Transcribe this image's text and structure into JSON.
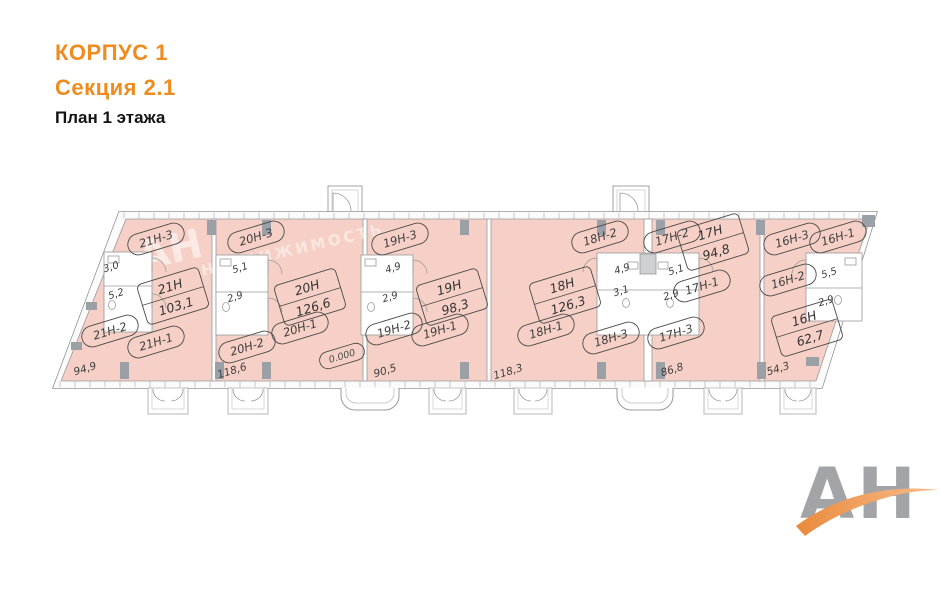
{
  "header": {
    "building": "КОРПУС 1",
    "section": "Секция 2.1",
    "floor": "План 1 этажа"
  },
  "watermark": {
    "line1": "АН",
    "line2": "НЕДВИЖИМОСТЬ"
  },
  "logo": {
    "text": "АН"
  },
  "colors": {
    "accent_orange": "#ee8c1f",
    "plan_fill": "#f6d0c6",
    "wall_gray": "#9a9a9a",
    "label_gray": "#3e3e3e",
    "logo_gray": "#a2a4a7",
    "logo_orange": "#ef9a55"
  },
  "plan": {
    "unit_ovals": [
      {
        "label": "21Н-3",
        "x": 156,
        "y": 239
      },
      {
        "label": "21Н-2",
        "x": 110,
        "y": 331
      },
      {
        "label": "21Н-1",
        "x": 156,
        "y": 342
      },
      {
        "label": "20Н-3",
        "x": 256,
        "y": 237
      },
      {
        "label": "20Н-2",
        "x": 247,
        "y": 347
      },
      {
        "label": "20Н-1",
        "x": 300,
        "y": 328
      },
      {
        "label": "19Н-3",
        "x": 400,
        "y": 239
      },
      {
        "label": "19Н-2",
        "x": 394,
        "y": 329
      },
      {
        "label": "19Н-1",
        "x": 440,
        "y": 330
      },
      {
        "label": "18Н-2",
        "x": 600,
        "y": 237
      },
      {
        "label": "18Н-1",
        "x": 546,
        "y": 330
      },
      {
        "label": "18Н-3",
        "x": 611,
        "y": 338
      },
      {
        "label": "17Н-2",
        "x": 672,
        "y": 237
      },
      {
        "label": "17Н-1",
        "x": 702,
        "y": 286
      },
      {
        "label": "17Н-3",
        "x": 676,
        "y": 333
      },
      {
        "label": "16Н-3",
        "x": 792,
        "y": 239
      },
      {
        "label": "16Н-1",
        "x": 838,
        "y": 237
      },
      {
        "label": "16Н-2",
        "x": 788,
        "y": 280
      },
      {
        "label": "0.000",
        "x": 342,
        "y": 356,
        "small": true
      }
    ],
    "area_boxes": [
      {
        "name": "21Н",
        "area": "103,1",
        "x": 173,
        "y": 296
      },
      {
        "name": "20Н",
        "area": "126,6",
        "x": 310,
        "y": 297
      },
      {
        "name": "19Н",
        "area": "98,3",
        "x": 452,
        "y": 297
      },
      {
        "name": "18Н",
        "area": "126,3",
        "x": 565,
        "y": 295
      },
      {
        "name": "17Н",
        "area": "94,8",
        "x": 713,
        "y": 242
      },
      {
        "name": "16Н",
        "area": "62,7",
        "x": 807,
        "y": 328
      }
    ],
    "room_sizes": [
      {
        "label": "3,0",
        "x": 112,
        "y": 270
      },
      {
        "label": "5,2",
        "x": 117,
        "y": 297
      },
      {
        "label": "5,1",
        "x": 241,
        "y": 271
      },
      {
        "label": "2,9",
        "x": 236,
        "y": 300
      },
      {
        "label": "4,9",
        "x": 394,
        "y": 271
      },
      {
        "label": "2,9",
        "x": 391,
        "y": 300
      },
      {
        "label": "4,9",
        "x": 623,
        "y": 272
      },
      {
        "label": "3,1",
        "x": 622,
        "y": 294
      },
      {
        "label": "5,1",
        "x": 677,
        "y": 273
      },
      {
        "label": "2,9",
        "x": 672,
        "y": 298
      },
      {
        "label": "5,5",
        "x": 830,
        "y": 276
      },
      {
        "label": "2,9",
        "x": 827,
        "y": 304
      }
    ],
    "dimensions": [
      {
        "label": "94,9",
        "x": 86,
        "y": 372
      },
      {
        "label": "118,6",
        "x": 233,
        "y": 374
      },
      {
        "label": "90,5",
        "x": 386,
        "y": 374
      },
      {
        "label": "118,3",
        "x": 509,
        "y": 375
      },
      {
        "label": "86,8",
        "x": 673,
        "y": 373
      },
      {
        "label": "54,3",
        "x": 779,
        "y": 372
      }
    ]
  }
}
